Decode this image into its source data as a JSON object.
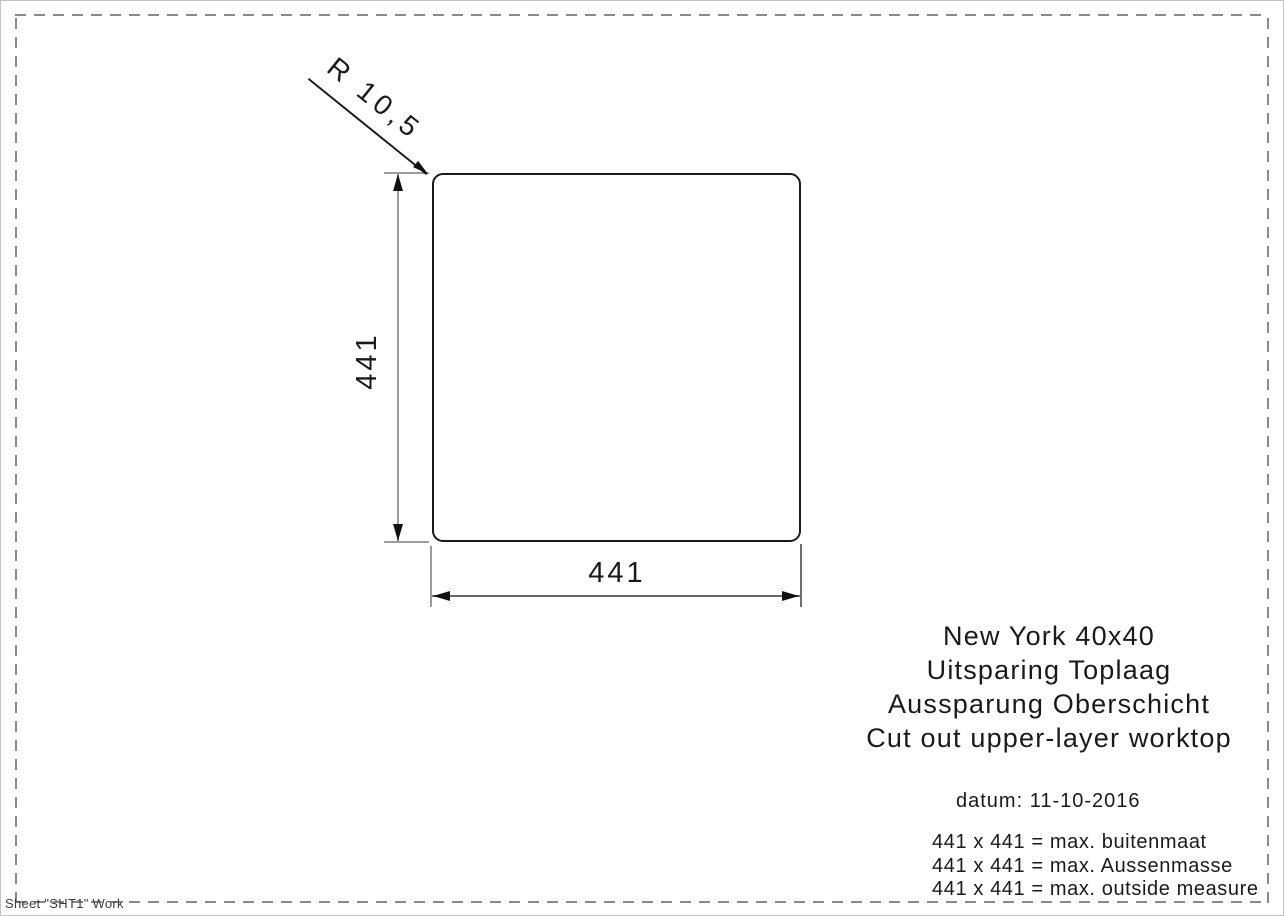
{
  "drawing": {
    "radius_label": "R 10,5",
    "vertical_dim": "441",
    "horizontal_dim": "441"
  },
  "title_block": {
    "lines": [
      "New York 40x40",
      "Uitsparing Toplaag",
      "Aussparung Oberschicht",
      "Cut out upper-layer worktop"
    ]
  },
  "info": {
    "date": "datum: 11-10-2016",
    "notes": [
      "441 x 441 = max. buitenmaat",
      "441 x 441 = max. Aussenmasse",
      "441 x 441 = max. outside measure"
    ]
  },
  "footer": {
    "sheet_label": "Sheet \"SHT1\" Work"
  },
  "colors": {
    "outline": "#1a1a1a",
    "dimension_line": "#9c9c9c",
    "arrow": "#111111",
    "dashed_border": "#8a8a8a",
    "text": "#1a1a1a"
  }
}
